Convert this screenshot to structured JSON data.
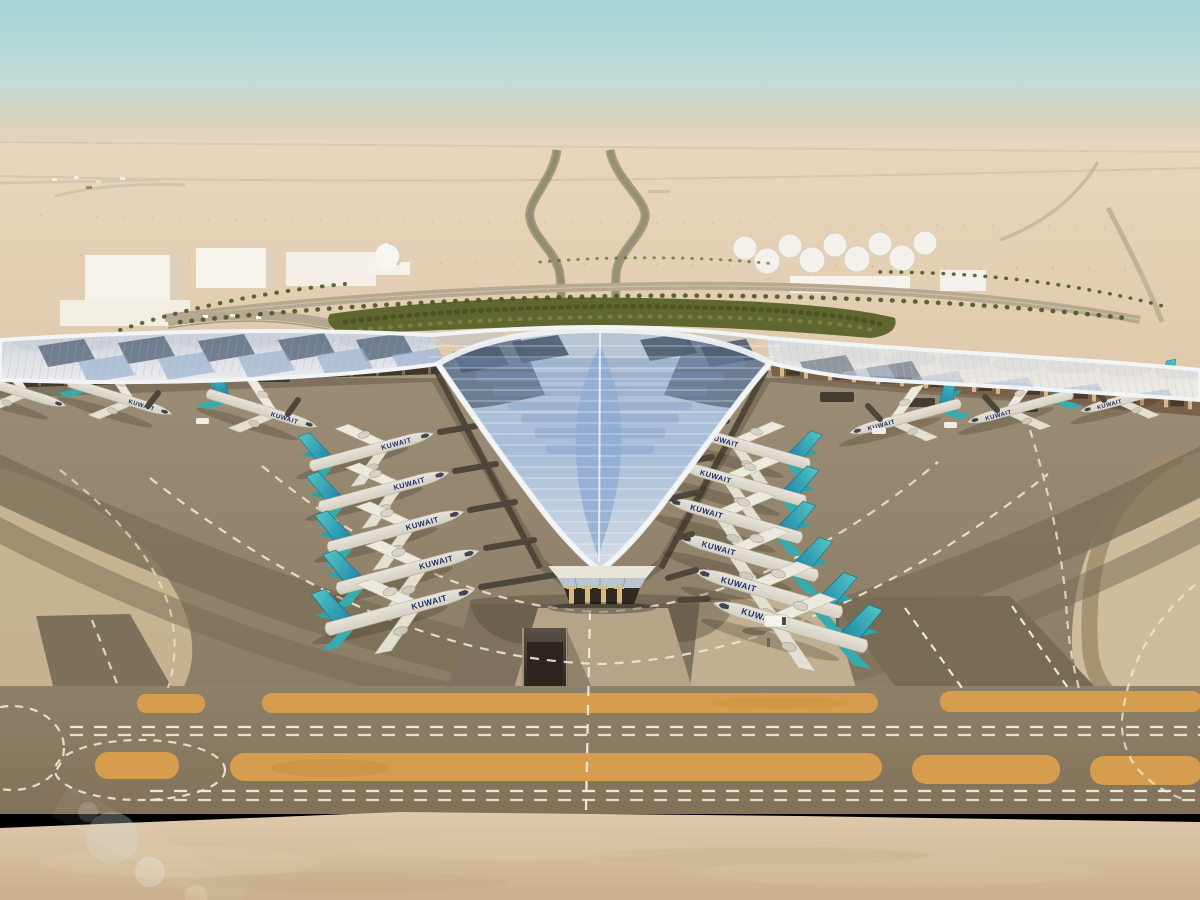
{
  "scene": {
    "description": "Aerial architectural rendering of a desert airport: a white trefoil-shaped terminal with feathered blue solar-panel roof, Kuwait-liveried aircraft parked at gates, curved concrete aprons and taxiways with ochre shoulder strips, palm-lined approach roads, fuel tanks and low white buildings on the horizon, sandy foreground",
    "aircraft_label": "KUWAIT",
    "aircraft_counts": {
      "left_pier_gates": 5,
      "right_pier_gates": 6,
      "west_wing_gates": 3,
      "east_wing_gates": 3,
      "partially_visible": 1
    },
    "palette": {
      "sky_top": "#a7d3d7",
      "sky_horizon": "#e9d8c0",
      "desert": "#e3cfb4",
      "sand_foreground": "#d2bb9c",
      "apron_gray": "#94866e",
      "asphalt_dark": "#7c6f58",
      "taxiway_ochre": "#d79d4e",
      "marking_white": "#efe8d6",
      "roof_white": "#eef0f2",
      "roof_solar_blue": "#8fabd2",
      "roof_solar_dark": "#56667c",
      "tail_teal": "#3cb6b8",
      "airline_navy": "#1d2f6e",
      "greenery": "#5f662f",
      "facade_tan": "#d2b184"
    },
    "elements": [
      "sky",
      "desert-horizon",
      "highway-lines",
      "fuel-tank-farm",
      "industrial-buildings",
      "dome-building",
      "palm-rows",
      "approach-roads",
      "green-landscape-band",
      "trefoil-terminal-roof",
      "solar-panel-feathers",
      "entrance-pavilion",
      "jet-bridges",
      "kuwait-aircraft",
      "concrete-apron",
      "taxiway-arcs",
      "ochre-strips",
      "dashed-taxi-guidelines",
      "underground-ramp",
      "service-van",
      "sand-foreground",
      "lens-flare"
    ]
  }
}
